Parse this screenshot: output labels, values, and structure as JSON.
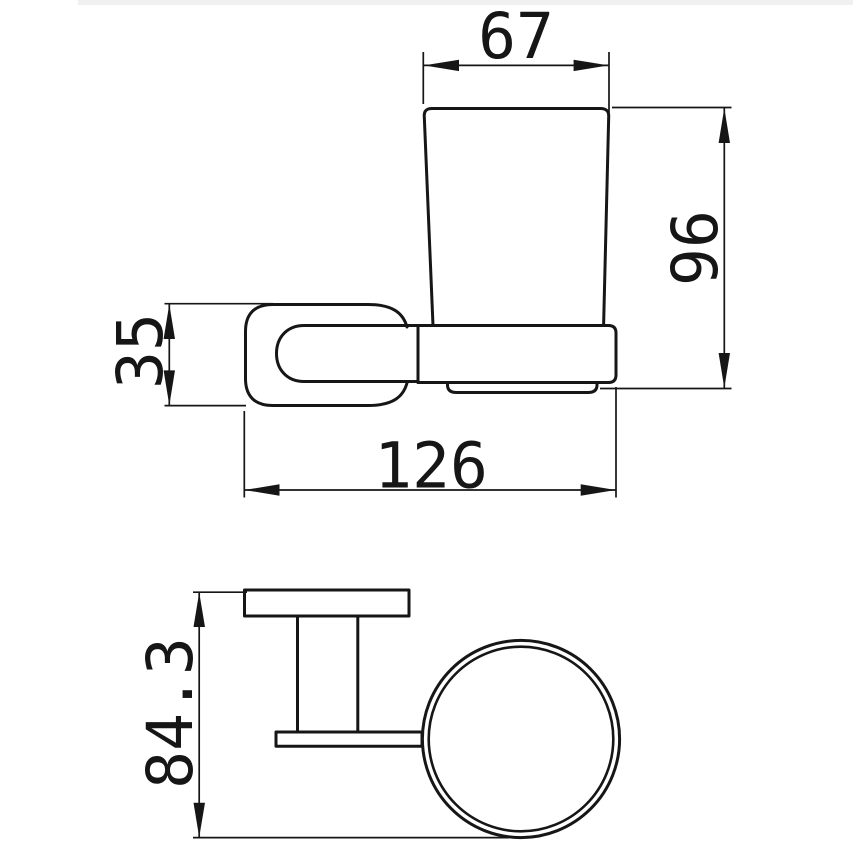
{
  "drawing": {
    "background_color": "#ffffff",
    "line_color": "#161616",
    "dimensions": {
      "cup_top_width": "67",
      "overall_height": "96",
      "wall_plate_height": "35",
      "overall_depth": "126",
      "plan_depth": "84.3"
    }
  }
}
